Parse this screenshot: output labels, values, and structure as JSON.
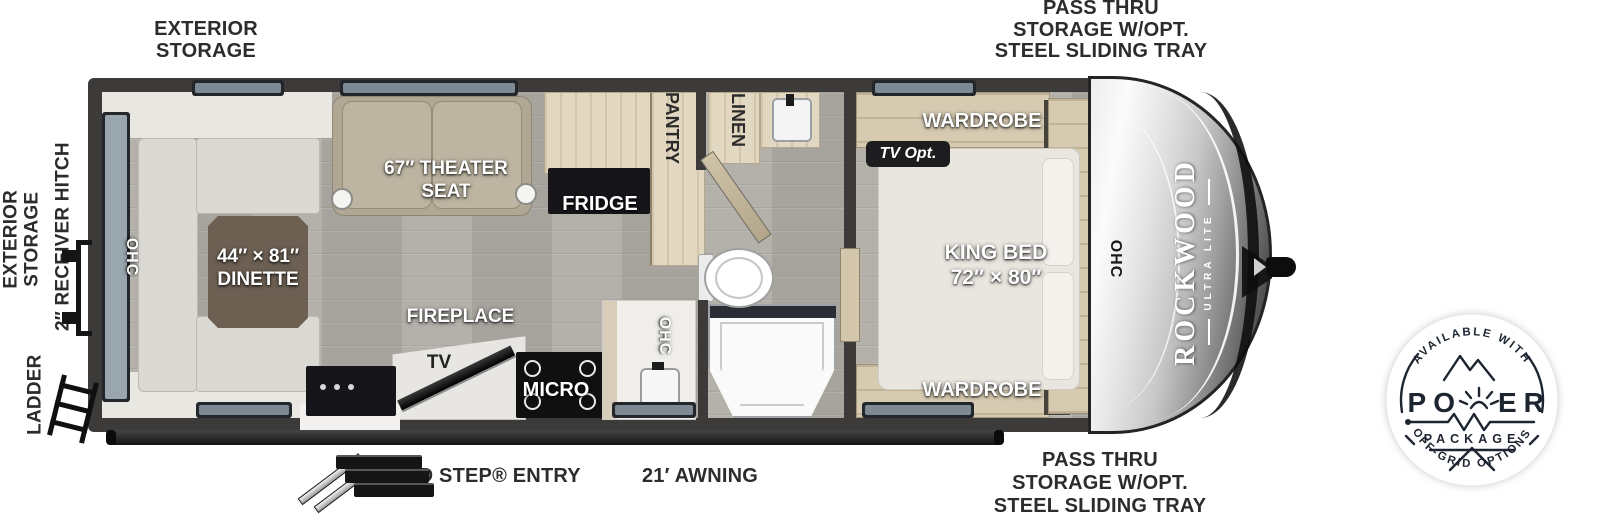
{
  "callouts": {
    "exterior_storage_top": {
      "l1": "EXTERIOR",
      "l2": "STORAGE"
    },
    "pass_thru_top": {
      "l1": "PASS THRU",
      "l2": "STORAGE W/OPT.",
      "l3": "STEEL SLIDING TRAY"
    },
    "exterior_storage_rear": {
      "l1": "EXTERIOR",
      "l2": "STORAGE"
    },
    "receiver_hitch": "2″ RECEIVER HITCH",
    "ladder": "LADDER",
    "solid_step": "SOLID STEP® ENTRY",
    "awning": "21′ AWNING",
    "pass_thru_bottom": {
      "l1": "PASS THRU",
      "l2": "STORAGE W/OPT.",
      "l3": "STEEL SLIDING TRAY"
    }
  },
  "interior": {
    "ohc_rear": "OHC",
    "dinette": {
      "l1": "44″ × 81″",
      "l2": "DINETTE"
    },
    "theater": {
      "l1": "67″ THEATER",
      "l2": "SEAT"
    },
    "fridge": "FRIDGE",
    "pantry": "PANTRY",
    "linen": "LINEN",
    "fireplace": "FIREPLACE",
    "tv": "TV",
    "micro": "MICRO",
    "ohc_kitchen": "OHC",
    "wardrobe_top": "WARDROBE",
    "tv_opt": "TV Opt.",
    "king_bed": {
      "l1": "KING BED",
      "l2": "72″ × 80″"
    },
    "wardrobe_bottom": "WARDROBE",
    "ohc_front": "OHC"
  },
  "brand": {
    "name": "ROCKWOOD",
    "sub": "ULTRA LITE"
  },
  "badge": {
    "arc_top": "AVAILABLE WITH",
    "power_left": "PO",
    "power_right": "ER",
    "package": "PACKAGE",
    "arc_bottom": "OFF-GRID OPTIONS"
  },
  "colors": {
    "wall": "#3c3b39",
    "label_ink": "#2c2c2c",
    "badge_ink": "#1d2530"
  }
}
